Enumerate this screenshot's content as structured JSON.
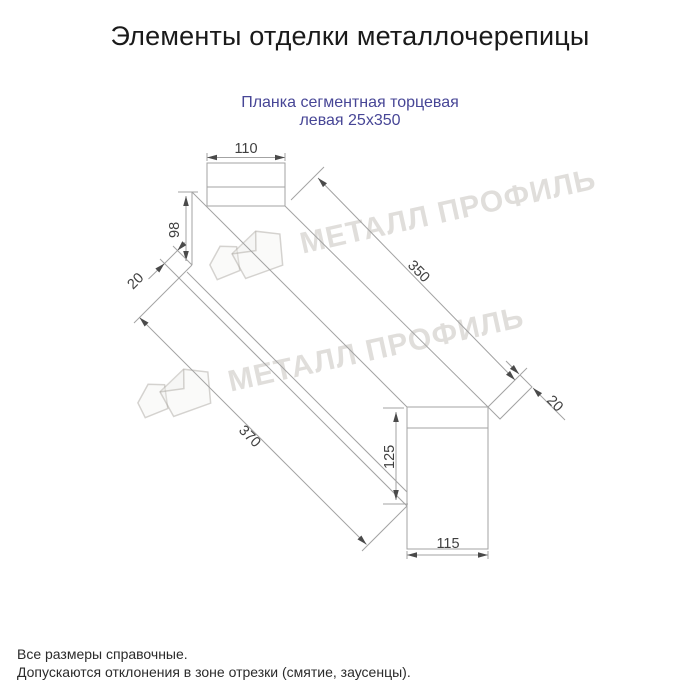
{
  "title": "Элементы отделки металлочерепицы",
  "subtitle": {
    "line1": "Планка сегментная торцевая",
    "line2": "левая 25x350"
  },
  "drawing": {
    "dimensions": {
      "cap_width": "110",
      "left_height": "98",
      "left_hem": "20",
      "top_length": "350",
      "bottom_length": "370",
      "right_height": "125",
      "right_width": "115",
      "right_hem": "20"
    }
  },
  "watermark": {
    "brand": "МЕТАЛЛ ПРОФИЛЬ"
  },
  "footer": {
    "line1": "Все размеры справочные.",
    "line2": "Допускаются отклонения в зоне отрезки (смятие, заусенцы)."
  },
  "colors": {
    "subtitle": "#474696",
    "drawing_line": "#a3a3a3",
    "dimension_text": "#3f3f3f",
    "title_text": "#1a1a1a",
    "footer_text": "#2b2b2b",
    "watermark": "#b2aca5"
  }
}
